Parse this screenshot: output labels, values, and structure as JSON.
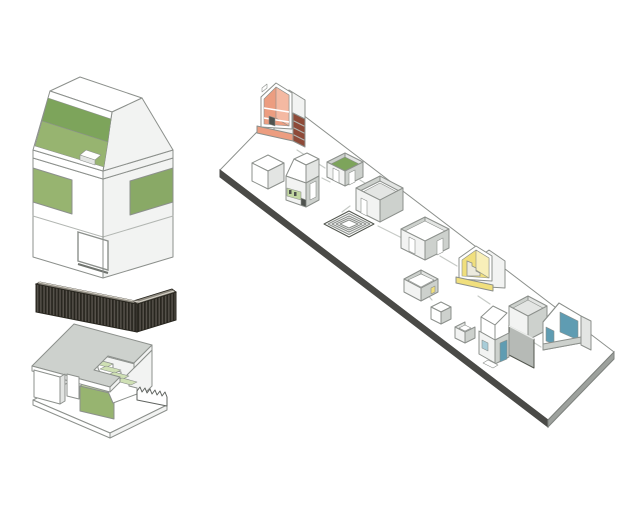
{
  "palette": {
    "paper": "#ffffff",
    "line": "#8c908c",
    "line-soft": "#b2b6b2",
    "line-dark": "#53574f",
    "connector": "#c6cac6",
    "white": "#ffffff",
    "offwhite": "#f2f3f2",
    "gray1": "#e3e5e3",
    "gray2": "#cdd1cd",
    "gray3": "#b6bab6",
    "green": "#97b470",
    "green2": "#89a966",
    "green-dark": "#7da45b",
    "green-light": "#c2d7a2",
    "green-pale": "#cfe0b4",
    "salmon": "#ec9d80",
    "salmon-light": "#f4b9a2",
    "maroon": "#8e4a38",
    "yellow": "#f0df7d",
    "yellow-pale": "#f8efb9",
    "teal": "#5f9cb2",
    "teal-light": "#a8ccd8",
    "dark-detail": "#4e524e",
    "louver-cap": "#8d897f",
    "louver-base": "#55514a",
    "louver-stripe": "#28261f",
    "slab-edge-dark": "#4a4a47",
    "slab-edge-light": "#9da19d"
  },
  "figures": {
    "exploded_house": {
      "parts": [
        "opened-mansard-roof",
        "clerestory-band",
        "lower-floor",
        "louver-screen",
        "ground-floor-with-stair"
      ]
    },
    "model_platform": {
      "models": [
        "sectioned-house-orange",
        "closed-cube",
        "mansard-house",
        "green-floor-room",
        "large-open-room",
        "sunken-courtyard-steps",
        "open-room-with-doorways",
        "sectioned-house-yellow",
        "small-open-room",
        "small-cube",
        "small-open-cube",
        "house-with-blue-door",
        "tall-open-room",
        "sectioned-house-blue"
      ]
    }
  }
}
